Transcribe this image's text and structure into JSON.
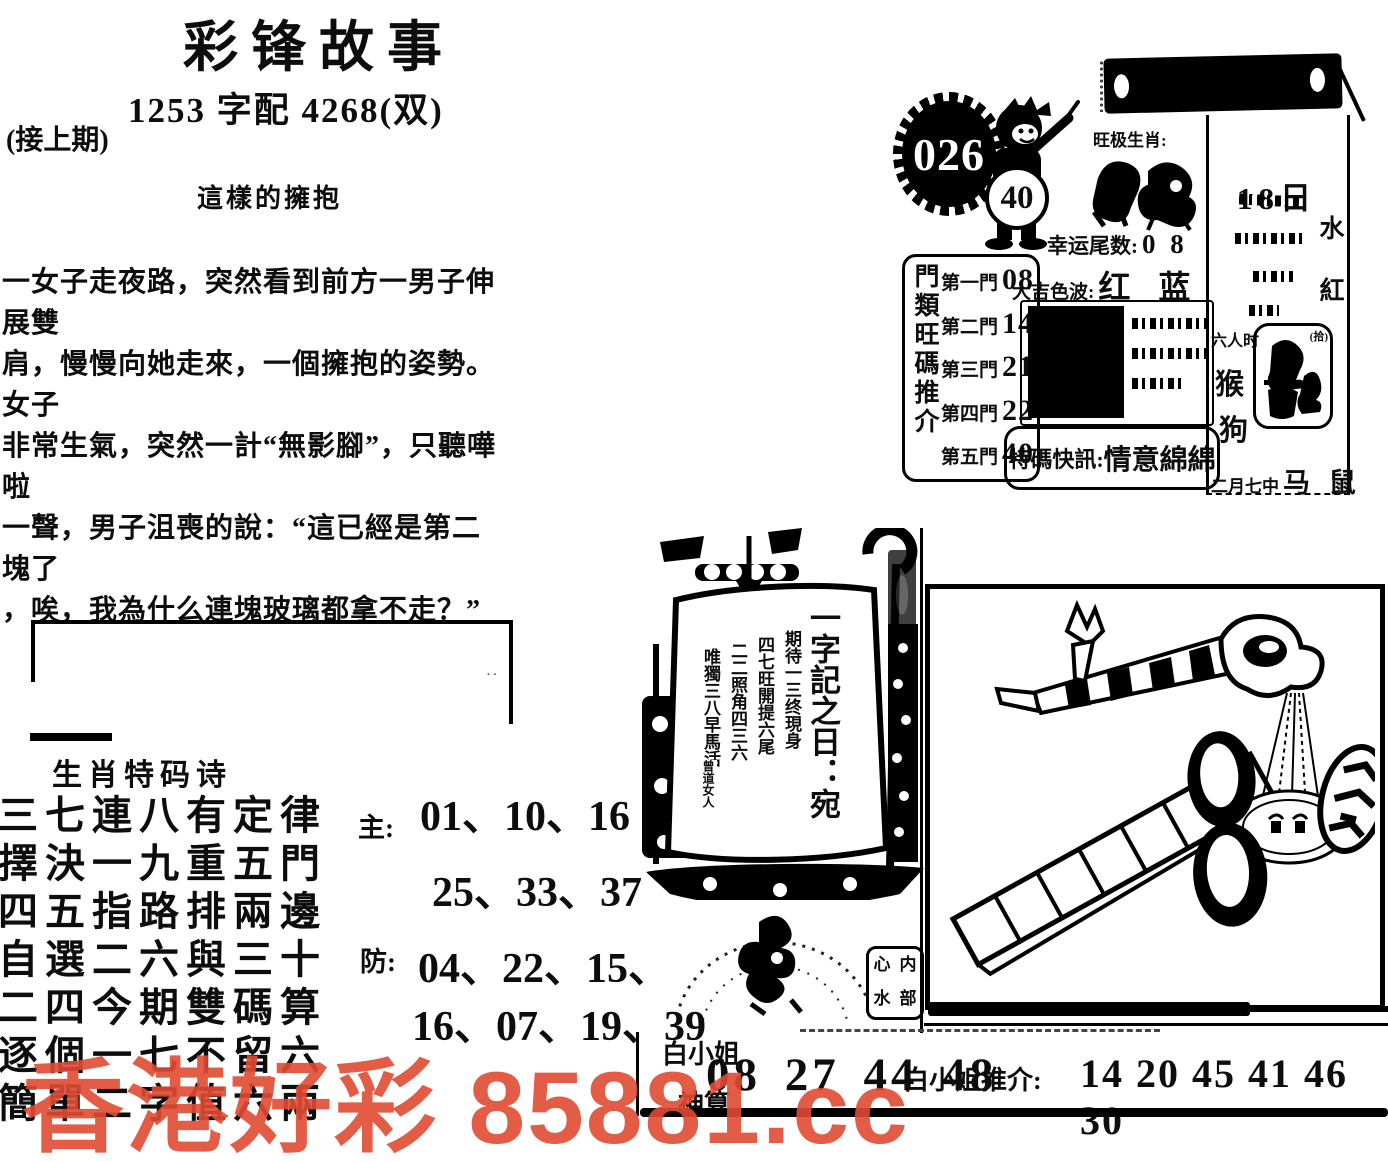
{
  "header": {
    "title": "彩锋故事",
    "subtitle": "1253 字配 4268(双)",
    "continued": "(接上期)",
    "story_title": "這樣的擁抱"
  },
  "story": {
    "text": "一女子走夜路，突然看到前方一男子伸展雙\n肩，慢慢向她走來，一個擁抱的姿勢。女子\n非常生氣，突然一計“無影腳”，只聽嘩啦\n一聲，男子沮喪的說：“這已經是第二塊了\n，唉，我為什么連塊玻璃都拿不走？”"
  },
  "issue": {
    "number": "026",
    "boy_number": "40",
    "zodiac_label": "旺极生肖:",
    "lucky_tail_label": "幸运尾数:",
    "lucky_tail_value": "0 8"
  },
  "doors": {
    "vertical_label": "門類旺碼推介",
    "rows": [
      {
        "label": "第一門",
        "num": "08"
      },
      {
        "label": "第二門",
        "num": "14"
      },
      {
        "label": "第三門",
        "num": "21"
      },
      {
        "label": "第四門",
        "num": "22"
      },
      {
        "label": "第五門",
        "num": "40"
      }
    ]
  },
  "waves": {
    "label": "大吉色波:",
    "value": "红 蓝"
  },
  "flash": {
    "label": "特碼快訊:",
    "value": "情意綿綿"
  },
  "calendar": {
    "date": "18日",
    "right_char1": "水",
    "right_char2": "紅",
    "guest": "六人时",
    "zodiac1": "猴",
    "zodiac2": "狗",
    "note": "(拾)",
    "bottom_small": "二月七中",
    "bottom_big": "马 鼠"
  },
  "ship": {
    "main": "一字記之日：宛",
    "line1": "期待一三终現身",
    "line2": "四七旺開提六尾",
    "line3": "二二照角四三六",
    "line4": "唯獨三八早馬活",
    "seal": "曾道女人"
  },
  "stamp": {
    "c1": "心",
    "c2": "内",
    "c3": "水",
    "c4": "部"
  },
  "poem": {
    "heading": "生肖特码诗",
    "lines": "三七連八有定律\n擇決一九重五門\n四五指路排兩邊\n自選二六與三十\n二四今期雙碼算\n逐個一七不留六\n簡單二字值六兩"
  },
  "numbers": {
    "main_label": "主:",
    "main1": "01、10、16",
    "main2": "25、33、37",
    "guard_label": "防:",
    "guard1": "04、22、15、",
    "guard2": "16、07、19、39"
  },
  "bottom": {
    "lady": "白小姐",
    "god": "神算",
    "nums1": "08 27 44 48",
    "rec_label": "白小姐推介:",
    "nums2": "14 20 45 41 46 30"
  },
  "watermark": {
    "text": "香港好彩 85881.cc",
    "color": "#e14b33"
  }
}
